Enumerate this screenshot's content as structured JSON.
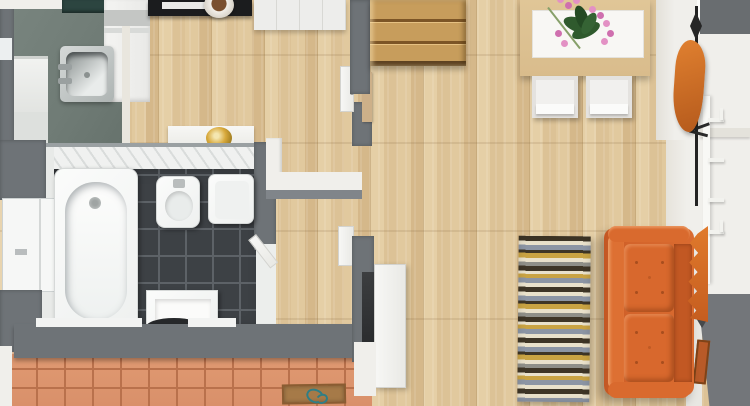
{
  "scene": {
    "type": "3d-floor-plan-top-view",
    "title": "Apartment 3D floor plan (top-down render)",
    "visible_text": []
  },
  "rooms": {
    "kitchen": {
      "label": "Kitchen (top left)"
    },
    "bathroom": {
      "label": "Bathroom with dark tile floor"
    },
    "living": {
      "label": "Living and dining room with wood floor"
    },
    "hall": {
      "label": "Entry hall with terracotta tiles"
    },
    "stairs": {
      "label": "Wooden staircase"
    }
  },
  "furniture": {
    "sink": {
      "label": "Stainless steel kitchen sink"
    },
    "stove": {
      "label": "Black stove"
    },
    "cooktop": {
      "label": "Dark cooktop"
    },
    "fridge": {
      "label": "White refrigerator cabinet"
    },
    "cabinets": {
      "label": "White kitchen cabinets"
    },
    "pot": {
      "label": "Pot on counter"
    },
    "vanity": {
      "label": "Vanity counter with gold basin"
    },
    "bathtub": {
      "label": "White bathtub"
    },
    "bidet": {
      "label": "Bidet"
    },
    "toilet": {
      "label": "Toilet"
    },
    "washbasin": {
      "label": "Washbasin"
    },
    "window": {
      "label": "Bathroom window bay"
    },
    "table": {
      "label": "Dining table with white runner"
    },
    "orchid": {
      "label": "Pink orchid centerpiece"
    },
    "chair_left": {
      "label": "Dining chair (left)"
    },
    "chair_right": {
      "label": "Dining chair (right)"
    },
    "coat_rack": {
      "label": "Black coat stand"
    },
    "coat": {
      "label": "Orange coat"
    },
    "hooks": {
      "label": "White wall hook rail"
    },
    "sofa": {
      "label": "Orange tufted sofa"
    },
    "blanket": {
      "label": "Orange throw blanket"
    },
    "rug": {
      "label": "Striped runner rug"
    },
    "doormat": {
      "label": "Brown doormat with teal motif"
    },
    "staircase": {
      "label": "Wooden stairs"
    },
    "door_open": {
      "label": "Open white door"
    },
    "picture": {
      "label": "Small picture on gray wall"
    }
  },
  "colors": {
    "wood": "#dfc79d",
    "sage": "#6f7b75",
    "tile-dark": "#3d4145",
    "grout": "#5d6267",
    "terracotta": "#d9906a",
    "terracotta-line": "#b9714c",
    "wall-gray": "#6e7377",
    "wall-white": "#f0efeb",
    "stairs-wood": "#c79d5c",
    "stairs-edge": "#7c5526",
    "table-wood": "#d9bc8c",
    "sofa": "#d4642b",
    "sofa-dark": "#a84e1e",
    "sofa-light": "#dd7033",
    "blanket": "#e07a2c",
    "coat": "#d97428",
    "orchid-pink": "#e391c4",
    "orchid-green": "#2f5a2d",
    "rug-dark": "#3e3526",
    "rug-cream": "#e9e1cb",
    "rug-blue": "#8c95a4",
    "rug-gold": "#c9a343",
    "rug-gray": "#8f8f88",
    "mat": "#a67a48",
    "mat-teal": "#2f7e85",
    "steel": "#b9bfbf",
    "gold-bowl": "#d8a93c",
    "stove-black": "#1b1c1e",
    "cooktop-teal": "#2c4540"
  }
}
